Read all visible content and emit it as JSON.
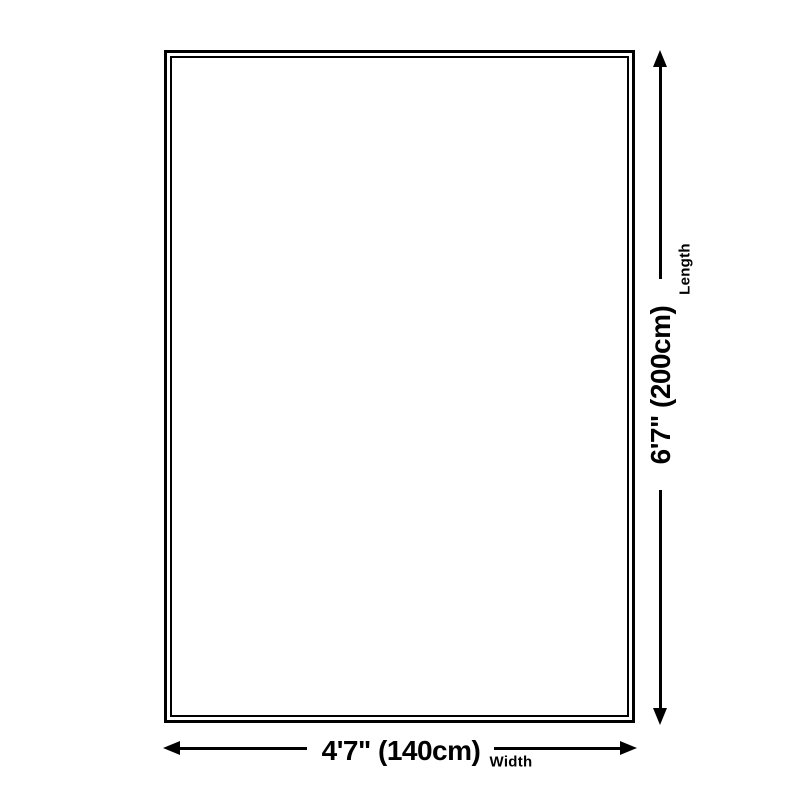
{
  "diagram": {
    "type": "product-size-diagram",
    "rug": {
      "shape": "rectangle",
      "fill": "#ffffff",
      "border_color": "#000000"
    },
    "length": {
      "value": "6'7\" (200cm)",
      "label": "Length"
    },
    "width": {
      "value": "4'7\" (140cm)",
      "label": "Width"
    },
    "icons": {
      "arrow_up": "triangle-up",
      "arrow_down": "triangle-down",
      "arrow_left": "triangle-left",
      "arrow_right": "triangle-right"
    },
    "colors": {
      "line": "#000000",
      "background": "#ffffff"
    }
  }
}
